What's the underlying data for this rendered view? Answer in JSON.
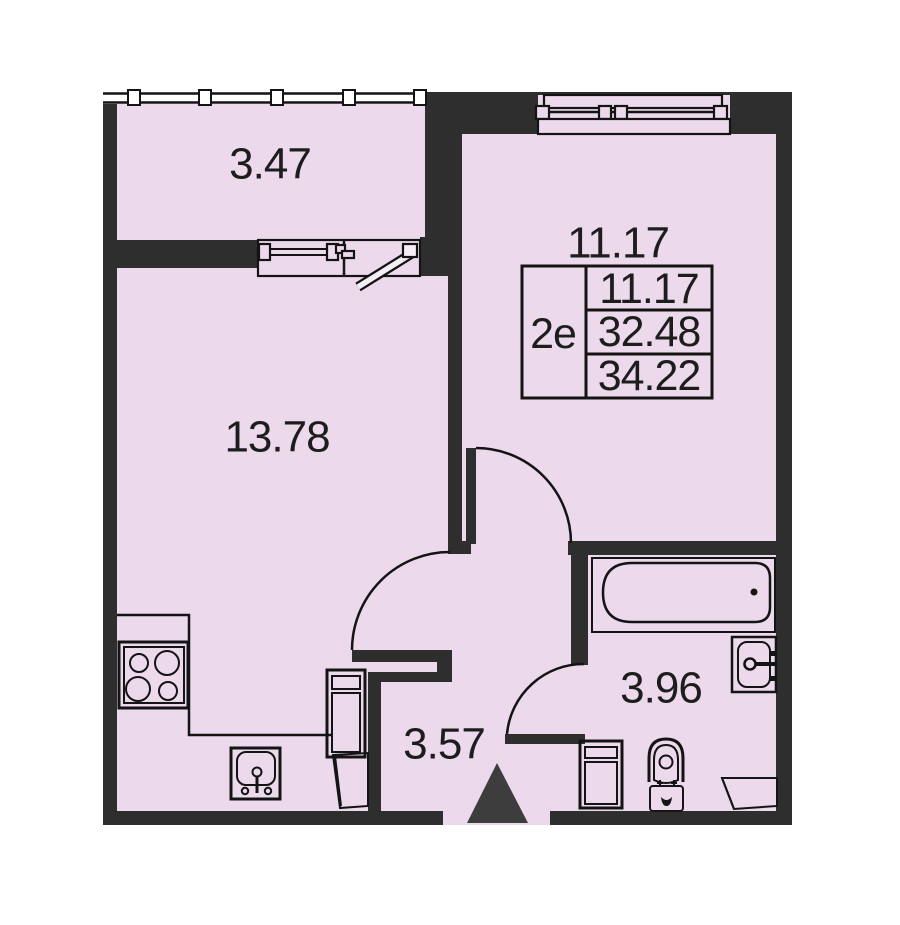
{
  "rooms": {
    "balcony": {
      "area": "3.47"
    },
    "living_kitchen": {
      "area": "13.78"
    },
    "bedroom": {
      "area": "11.17"
    },
    "hallway": {
      "area": "3.57"
    },
    "bathroom": {
      "area": "3.96"
    }
  },
  "info_table": {
    "unit_type": "2e",
    "values": [
      "11.17",
      "32.48",
      "34.22"
    ]
  },
  "fixtures": [
    "stove",
    "kitchen-sink",
    "tall-cabinet",
    "bathtub",
    "wash-basin",
    "washing-machine",
    "toilet",
    "entrance-arrow"
  ],
  "colors": {
    "floor": "#ecdaec",
    "wall": "#2e2e2e",
    "line": "#141414",
    "entrance_arrow": "#3d3d3d"
  }
}
